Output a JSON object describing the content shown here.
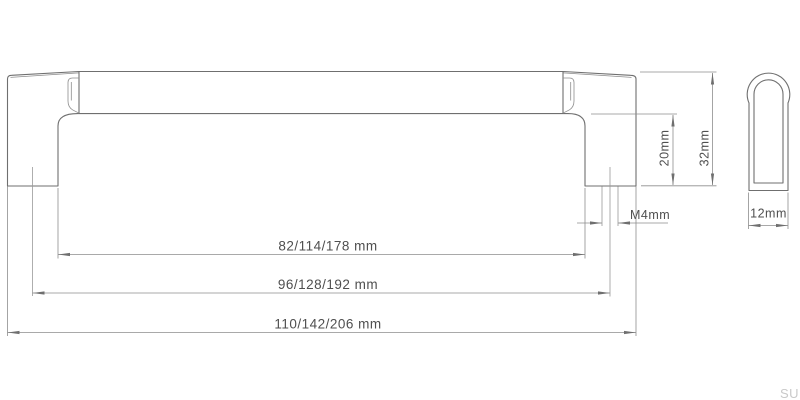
{
  "drawing": {
    "kind": "furniture-handle-dimension-drawing",
    "watermark": "SU",
    "dimensions": {
      "inner_length": "82/114/178 mm",
      "hole_spacing": "96/128/192 mm",
      "overall_length": "110/142/206 mm",
      "screw_thread": "M4mm",
      "post_height": "20mm",
      "overall_height": "32mm",
      "depth": "12mm"
    },
    "colors": {
      "object_line": "#6f6f6f",
      "dimension_line": "#8d8d8d",
      "label_text": "#4f4f4f",
      "watermark_text": "#c9c9c9",
      "background": "#ffffff"
    }
  }
}
